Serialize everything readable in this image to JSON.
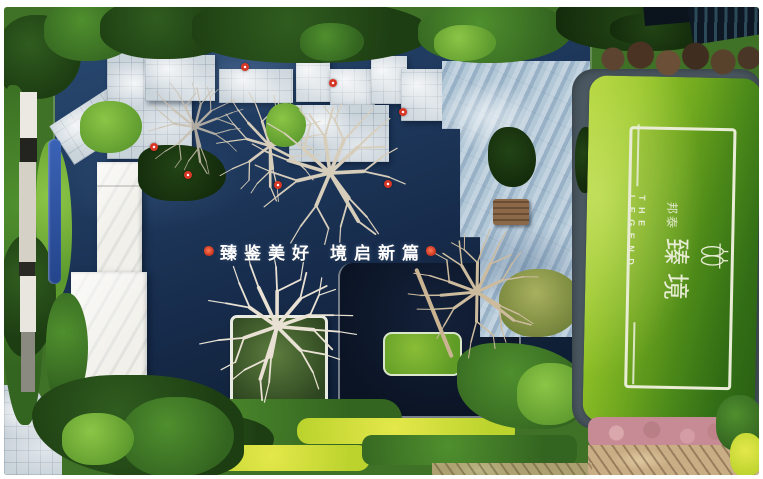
{
  "photo": {
    "kind": "aerial-garden-photo",
    "slogan": {
      "part1": "臻鉴美好",
      "part2": "境启新篇"
    },
    "sign": {
      "brand_prefix": "邦泰",
      "brand_name": "臻境",
      "english": "THE LEGEND"
    },
    "markers": {
      "red_float_count": 7,
      "color": "#d63726"
    },
    "palette": {
      "pool_navy": "#1b3557",
      "pool_shadow": "#0d1726",
      "pavement": "#c9d3da",
      "patio_stone": "#a9c0d2",
      "deck_white": "#f1f0ea",
      "lawn_sunlit": "#a6ce33",
      "lawn_shaded": "#2f6414",
      "foliage_dark": "#1e3d12",
      "foliage_mid": "#3f7a26",
      "flower_yellow": "#dce33c",
      "flower_pink": "#c68b94",
      "sign_text": "#e7ecd4",
      "slogan_text": "#ffffff"
    }
  }
}
